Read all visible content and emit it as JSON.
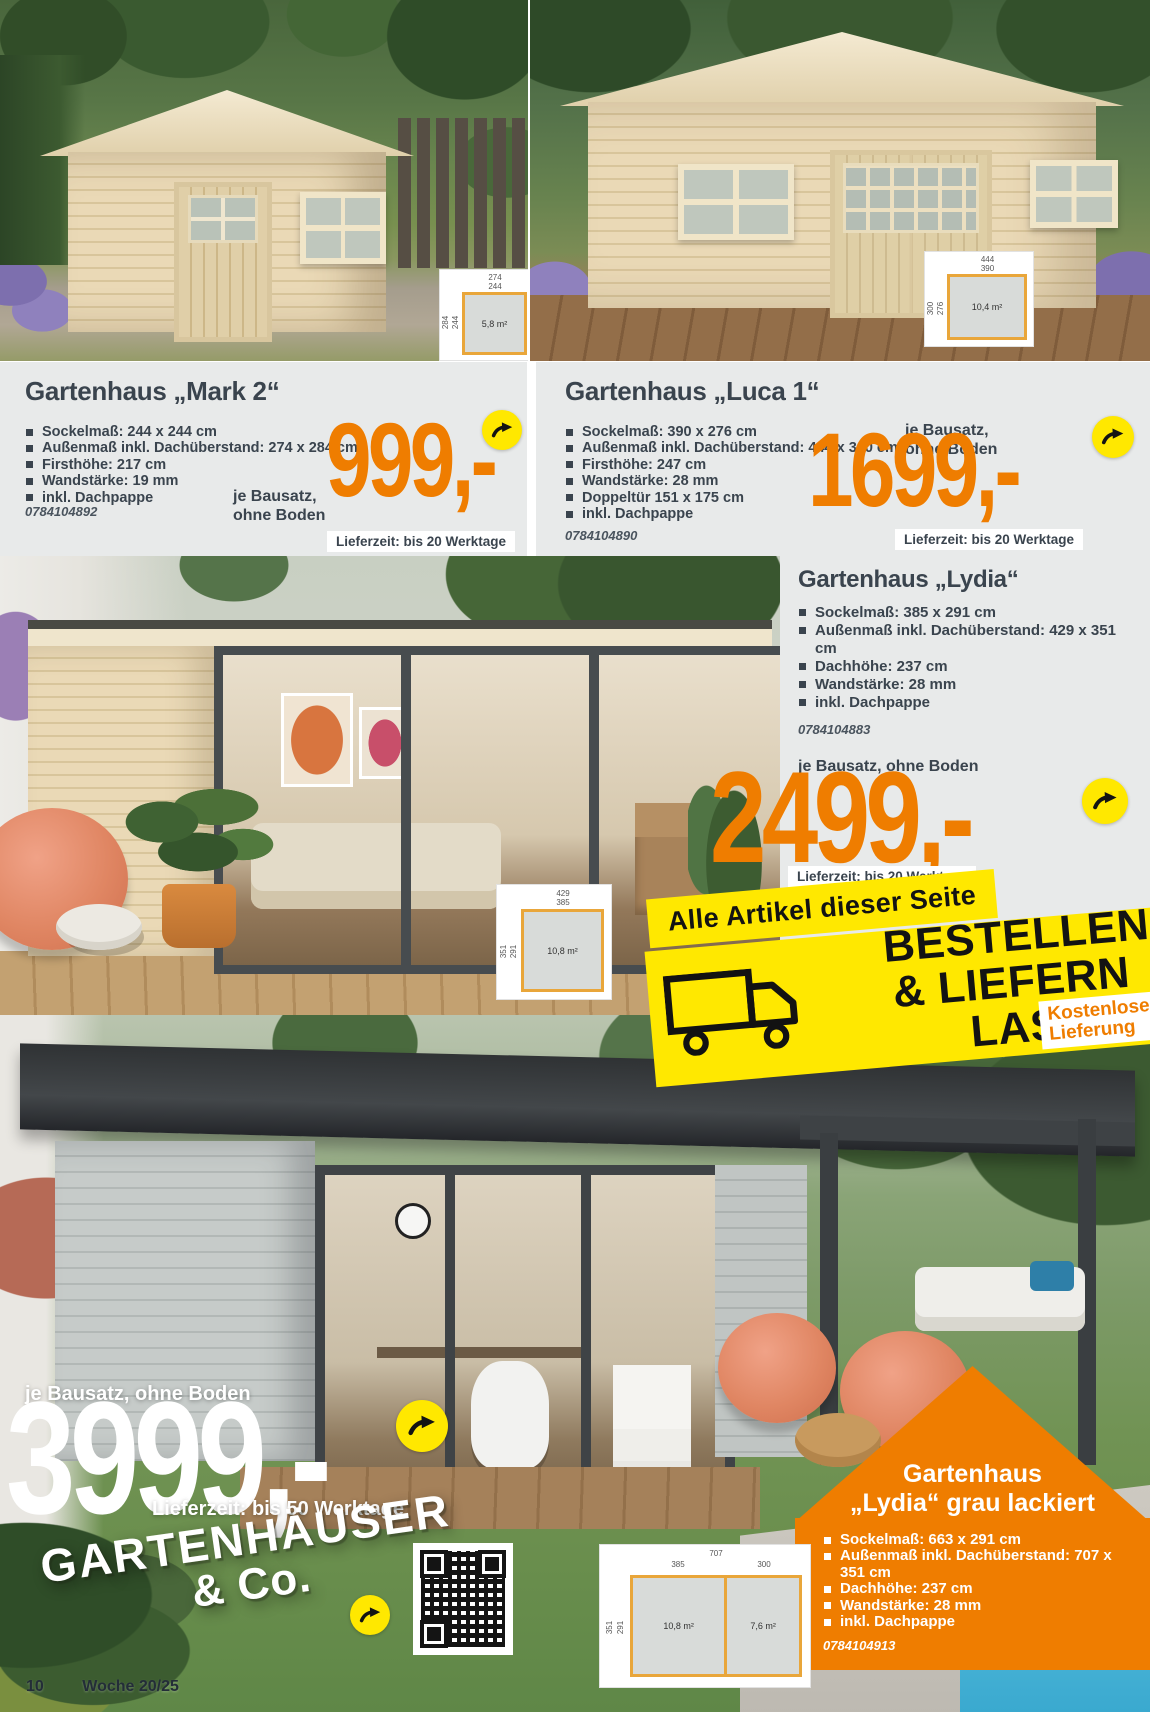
{
  "footer": {
    "page_number": "10",
    "week": "Woche 20/25"
  },
  "colors": {
    "accent_orange": "#ef7d00",
    "signal_yellow": "#ffe800",
    "text_dark": "#3a444e"
  },
  "icons": {
    "order_arrow": "curved-arrow-right-in-yellow-circle",
    "delivery_truck": "truck-outline",
    "qr_code": "qr-code"
  },
  "products": [
    {
      "title": "Gartenhaus „Mark 2“",
      "specs": [
        "Sockelmaß: 244 x 244 cm",
        "Außenmaß inkl. Dachüberstand: 274 x 284 cm",
        "Firsthöhe: 217 cm",
        "Wandstärke: 19 mm",
        "inkl. Dachpappe"
      ],
      "sku": "0784104892",
      "unit_note_line1": "je Bausatz,",
      "unit_note_line2": "ohne Boden",
      "price": "999,-",
      "delivery": "Lieferzeit: bis 20 Werktage",
      "plan": {
        "outer_width": "274",
        "inner_width": "244",
        "outer_depth": "284",
        "inner_depth": "244",
        "area": "5,8 m²"
      }
    },
    {
      "title": "Gartenhaus „Luca 1“",
      "specs": [
        "Sockelmaß: 390 x 276 cm",
        "Außenmaß inkl. Dachüberstand: 444 x 300 cm",
        "Firsthöhe: 247 cm",
        "Wandstärke: 28 mm",
        "Doppeltür 151 x 175 cm",
        "inkl. Dachpappe"
      ],
      "sku": "0784104890",
      "unit_note_line1": "je Bausatz,",
      "unit_note_line2": "ohne Boden",
      "price": "1699,-",
      "delivery": "Lieferzeit: bis 20 Werktage",
      "plan": {
        "outer_width": "444",
        "inner_width": "390",
        "outer_depth": "300",
        "inner_depth": "276",
        "area": "10,4 m²"
      }
    },
    {
      "title": "Gartenhaus „Lydia“",
      "specs": [
        "Sockelmaß: 385 x 291 cm",
        "Außenmaß inkl. Dachüberstand: 429 x 351 cm",
        "Dachhöhe: 237 cm",
        "Wandstärke: 28 mm",
        "inkl. Dachpappe"
      ],
      "sku": "0784104883",
      "unit_note": "je Bausatz, ohne Boden",
      "price": "2499,-",
      "delivery": "Lieferzeit: bis 20 Werktage",
      "plan": {
        "outer_width": "429",
        "inner_width": "385",
        "outer_depth": "351",
        "inner_depth": "291",
        "area": "10,8 m²"
      }
    },
    {
      "title_line1": "Gartenhaus",
      "title_line2": "„Lydia“ grau lackiert",
      "specs": [
        "Sockelmaß: 663 x 291 cm",
        "Außenmaß inkl. Dachüberstand: 707 x 351 cm",
        "Dachhöhe: 237 cm",
        "Wandstärke: 28 mm",
        "inkl. Dachpappe"
      ],
      "sku": "0784104913",
      "unit_note": "je Bausatz, ohne Boden",
      "price": "3999,-",
      "delivery": "Lieferzeit: bis 50 Werktage",
      "plan": {
        "total_width": "707",
        "left_width": "385",
        "right_width": "300",
        "outer_depth": "351",
        "inner_depth": "291",
        "area_left": "10,8 m²",
        "area_right": "7,6 m²"
      }
    }
  ],
  "banner": {
    "line1": "Alle Artikel dieser Seite",
    "line2": "BESTELLEN",
    "line3": "& LIEFERN",
    "line4": "LASSEN",
    "free_delivery_line1": "Kostenlose",
    "free_delivery_line2": "Lieferung"
  },
  "bottom_headline": {
    "line1": "GARTENHÄUSER",
    "line2": "& Co."
  }
}
